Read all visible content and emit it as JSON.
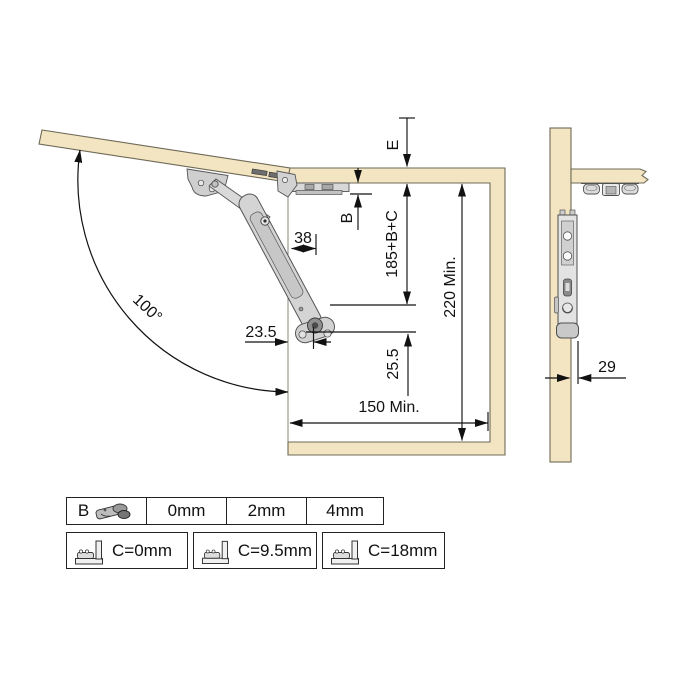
{
  "drawing": {
    "angle": "100°",
    "dims": {
      "e": "E",
      "b": "B",
      "arm_offset": "38",
      "height_formula": "185+B+C",
      "min_height": "220 Min.",
      "pivot_drop": "25.5",
      "front_offset": "23.5",
      "min_depth": "150 Min.",
      "side_offset": "29"
    },
    "colors": {
      "wood": "#F3E5C1",
      "wood_edge": "#6E6A57",
      "metal": "#D6D6D6",
      "metal_edge": "#4F4F4F",
      "line": "#111111"
    }
  },
  "b_table": {
    "label": "B",
    "icon": "hinge-3d-icon",
    "values": [
      "0mm",
      "2mm",
      "4mm"
    ]
  },
  "c_options": [
    {
      "label": "C=0mm",
      "icon": "hinge-section-icon"
    },
    {
      "label": "C=9.5mm",
      "icon": "hinge-section-icon"
    },
    {
      "label": "C=18mm",
      "icon": "hinge-section-icon"
    }
  ]
}
